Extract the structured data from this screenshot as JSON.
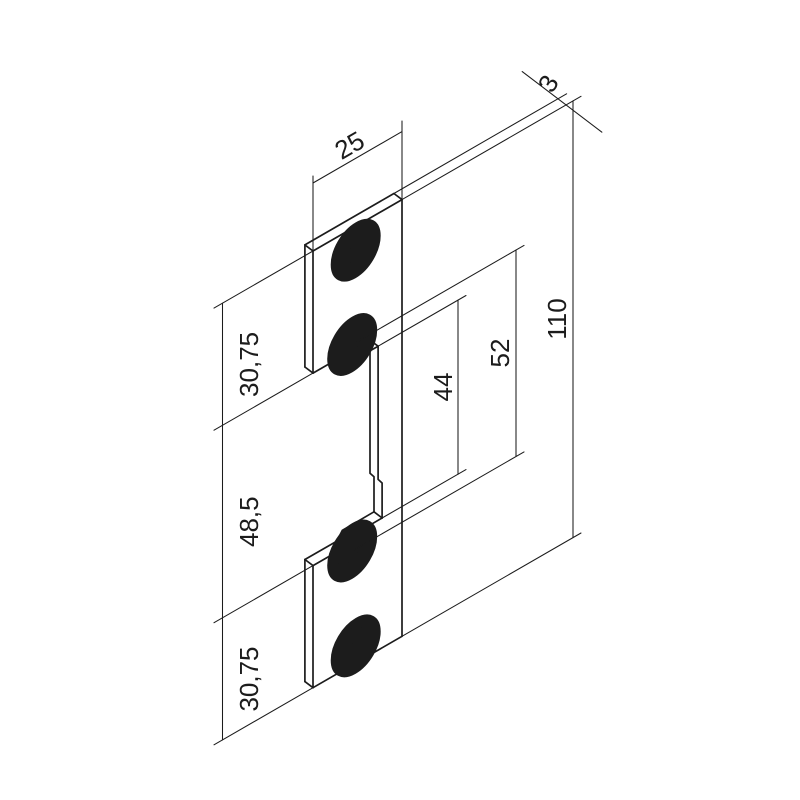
{
  "drawing": {
    "kind": "isometric technical drawing",
    "part": "strike plate faceplate",
    "units": "mm",
    "background_color": "#ffffff",
    "line_color": "#1c1c1c",
    "labels": {
      "plate_width": "25",
      "plate_thickness": "3",
      "plate_height": "110",
      "top_section_height": "30,75",
      "middle_section_height": "48,5",
      "bottom_section_height": "30,75",
      "latch_opening_height": "44",
      "screw_hole_spacing": "52"
    },
    "dimensions_mm": {
      "plate_width": 25,
      "plate_thickness": 3,
      "plate_height": 110,
      "top_section_height": 30.75,
      "middle_section_height": 48.5,
      "bottom_section_height": 30.75,
      "latch_opening_height": 44,
      "screw_hole_spacing": 52
    },
    "features": {
      "screw_hole_count": 4,
      "hole_style": "countersunk"
    }
  }
}
